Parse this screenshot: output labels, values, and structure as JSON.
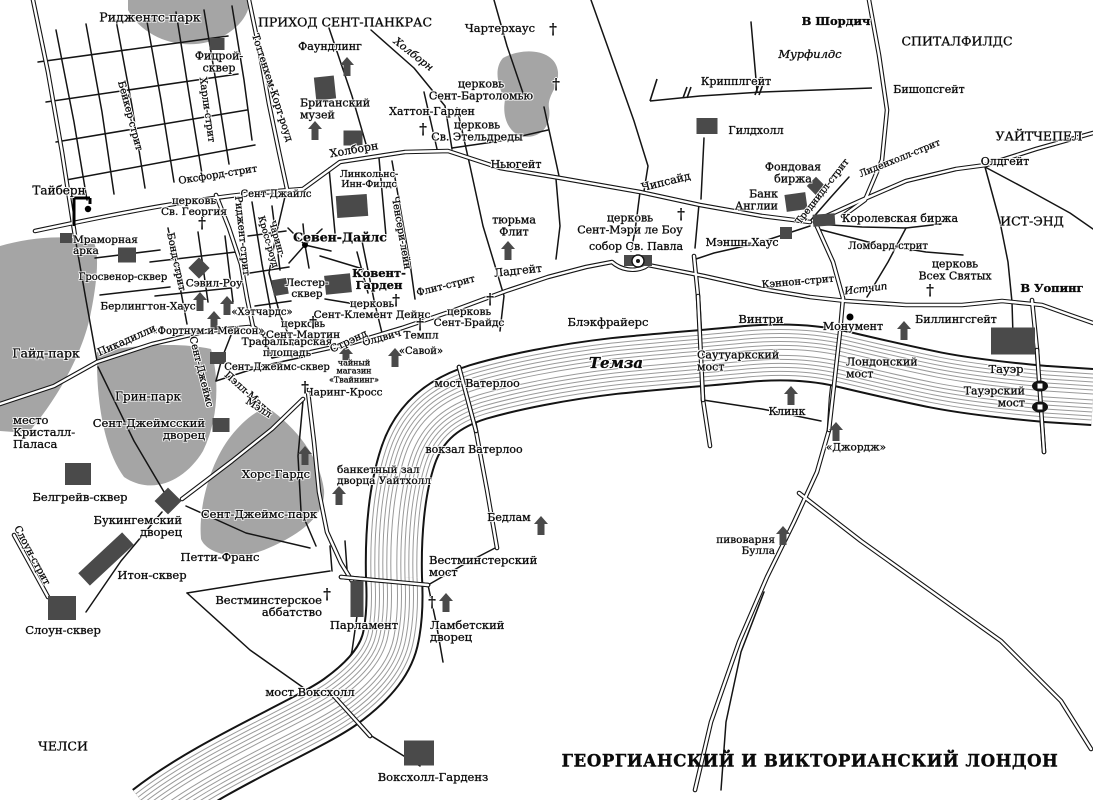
{
  "title": "ГЕОРГИАНСКИЙ И ВИКТОРИАНСКИЙ ЛОНДОН",
  "map": {
    "river_name": "Темза",
    "cross_glyph": "†",
    "labels": [
      {
        "t": "Риджентс-парк",
        "x": 150,
        "y": 17,
        "s": 12.5
      },
      {
        "t": "ПРИХОД СЕНТ-ПАНКРАС",
        "x": 345,
        "y": 22,
        "s": 12.5
      },
      {
        "t": "Чартерхаус",
        "x": 500,
        "y": 28,
        "s": 11.5
      },
      {
        "t": "В Шордич",
        "x": 836,
        "y": 21,
        "s": 11.5,
        "b": 1
      },
      {
        "t": "СПИТАЛФИЛДС",
        "x": 957,
        "y": 41,
        "s": 12.5
      },
      {
        "t": "Мурфилдс",
        "x": 810,
        "y": 54,
        "s": 11.5,
        "i": 1
      },
      {
        "t": "Фицрой-|сквер",
        "x": 219,
        "y": 62,
        "s": 11
      },
      {
        "t": "Фаундлинг",
        "x": 330,
        "y": 47,
        "s": 11
      },
      {
        "t": "Холборн",
        "x": 413,
        "y": 55,
        "s": 10.5,
        "i": 1,
        "r": 38
      },
      {
        "t": "церковь|Сент-Бартоломью",
        "x": 481,
        "y": 90,
        "s": 11
      },
      {
        "t": "Крипплгейт",
        "x": 736,
        "y": 82,
        "s": 11
      },
      {
        "t": "Бишопсгейт",
        "x": 929,
        "y": 90,
        "s": 11
      },
      {
        "t": "Британский|музей",
        "x": 300,
        "y": 109,
        "s": 11,
        "a": "l"
      },
      {
        "t": "Хаттон-Гарден",
        "x": 432,
        "y": 112,
        "s": 11
      },
      {
        "t": "церковь|Св. Этельдреды",
        "x": 477,
        "y": 131,
        "s": 11
      },
      {
        "t": "УАЙТЧЕПЕЛ",
        "x": 1039,
        "y": 136,
        "s": 12.5
      },
      {
        "t": "Гилдхолл",
        "x": 756,
        "y": 131,
        "s": 11
      },
      {
        "t": "Холборн",
        "x": 354,
        "y": 150,
        "s": 11,
        "r": -10
      },
      {
        "t": "Ньюгейт",
        "x": 516,
        "y": 165,
        "s": 11
      },
      {
        "t": "Олдгейт",
        "x": 1005,
        "y": 162,
        "s": 11
      },
      {
        "t": "Оксфорд-стрит",
        "x": 218,
        "y": 176,
        "s": 10,
        "r": -9
      },
      {
        "t": "Линкольнс-|Инн-Филдс",
        "x": 369,
        "y": 180,
        "s": 9.5
      },
      {
        "t": "Фондовая|биржа",
        "x": 793,
        "y": 173,
        "s": 11
      },
      {
        "t": "Тайберн",
        "x": 59,
        "y": 191,
        "s": 12
      },
      {
        "t": "Сент-Джайлс",
        "x": 276,
        "y": 195,
        "s": 10
      },
      {
        "t": "церковь|Св. Георгия",
        "x": 194,
        "y": 207,
        "s": 10.5
      },
      {
        "t": "Банк|Англии",
        "x": 778,
        "y": 200,
        "s": 11,
        "a": "r"
      },
      {
        "t": "Королевская биржа",
        "x": 900,
        "y": 219,
        "s": 11
      },
      {
        "t": "Лиденхолл-стрит",
        "x": 900,
        "y": 159,
        "s": 9.5,
        "r": -22
      },
      {
        "t": "Треднидл-стрит",
        "x": 823,
        "y": 192,
        "s": 9.5,
        "r": -52
      },
      {
        "t": "тюрьма|Флит",
        "x": 514,
        "y": 226,
        "s": 11
      },
      {
        "t": "ИСТ-ЭНД",
        "x": 1032,
        "y": 221,
        "s": 12.5
      },
      {
        "t": "Севен-Дайлс",
        "x": 340,
        "y": 237,
        "s": 12.5,
        "b": 1
      },
      {
        "t": "церковь|Сент-Мэри ле Боу",
        "x": 630,
        "y": 224,
        "s": 11
      },
      {
        "t": "собор Св. Павла",
        "x": 636,
        "y": 247,
        "s": 11
      },
      {
        "t": "Мэншн-Хаус",
        "x": 742,
        "y": 243,
        "s": 11
      },
      {
        "t": "Ломбард-стрит",
        "x": 888,
        "y": 247,
        "s": 10
      },
      {
        "t": "церковь|Всех Святых",
        "x": 955,
        "y": 270,
        "s": 11
      },
      {
        "t": "В Уопинг",
        "x": 1052,
        "y": 288,
        "s": 11.5,
        "b": 1
      },
      {
        "t": "Мраморная|арка",
        "x": 73,
        "y": 246,
        "s": 10.5,
        "a": "l"
      },
      {
        "t": "Чипсайд",
        "x": 666,
        "y": 182,
        "s": 11,
        "r": -14
      },
      {
        "t": "Гайд-парк",
        "x": 46,
        "y": 353,
        "s": 12.5
      },
      {
        "t": "Гросвенор-сквер",
        "x": 123,
        "y": 278,
        "s": 10
      },
      {
        "t": "Сэвил-Роу",
        "x": 214,
        "y": 284,
        "s": 10.5
      },
      {
        "t": "Лестер-|сквер",
        "x": 307,
        "y": 289,
        "s": 10.5
      },
      {
        "t": "Ковент-|Гарден",
        "x": 379,
        "y": 279,
        "s": 11.5,
        "b": 1
      },
      {
        "t": "Берлингтон-Хаус",
        "x": 148,
        "y": 307,
        "s": 10.5
      },
      {
        "t": "«Хэтчардс»",
        "x": 262,
        "y": 313,
        "s": 10
      },
      {
        "t": "церковь|Сент-Мартин",
        "x": 303,
        "y": 330,
        "s": 10.5
      },
      {
        "t": "«Фортнум и Мейсон»",
        "x": 208,
        "y": 332,
        "s": 10
      },
      {
        "t": "Пикадилли",
        "x": 127,
        "y": 341,
        "s": 10.5,
        "r": -24
      },
      {
        "t": "Трафальгарская|площадь",
        "x": 287,
        "y": 348,
        "s": 10.5
      },
      {
        "t": "Сент-Джеймс-сквер",
        "x": 277,
        "y": 368,
        "s": 10
      },
      {
        "t": "чайный|магазин|«Твайнинг»",
        "x": 354,
        "y": 372,
        "s": 8
      },
      {
        "t": "Чаринг-Кросс",
        "x": 344,
        "y": 393,
        "s": 10.5
      },
      {
        "t": "церковь|Сент-Клемент Дейнс",
        "x": 372,
        "y": 310,
        "s": 10.5
      },
      {
        "t": "Темпл",
        "x": 421,
        "y": 336,
        "s": 10.5
      },
      {
        "t": "«Савой»",
        "x": 421,
        "y": 352,
        "s": 10
      },
      {
        "t": "Олдвич",
        "x": 382,
        "y": 339,
        "s": 10,
        "r": -15
      },
      {
        "t": "Стрэнд",
        "x": 349,
        "y": 342,
        "s": 10.5,
        "r": -25
      },
      {
        "t": "Флит-стрит",
        "x": 446,
        "y": 287,
        "s": 10,
        "r": -14
      },
      {
        "t": "Ладгейт",
        "x": 518,
        "y": 271,
        "s": 11,
        "r": -6
      },
      {
        "t": "церковь|Сент-Брайдс",
        "x": 469,
        "y": 318,
        "s": 10.5
      },
      {
        "t": "Блэкфрайерс",
        "x": 608,
        "y": 322,
        "s": 11.5
      },
      {
        "t": "Темза",
        "x": 616,
        "y": 364,
        "s": 15,
        "b": 1,
        "i": 1
      },
      {
        "t": "мост Ватерлоо",
        "x": 477,
        "y": 384,
        "s": 11
      },
      {
        "t": "вокзал Ватерлоо",
        "x": 474,
        "y": 450,
        "s": 11
      },
      {
        "t": "банкетный зал|дворца Уайтхолл",
        "x": 337,
        "y": 476,
        "s": 10.5,
        "a": "l"
      },
      {
        "t": "Бедлам",
        "x": 509,
        "y": 518,
        "s": 11
      },
      {
        "t": "Саутуаркский|мост",
        "x": 697,
        "y": 361,
        "s": 11,
        "a": "l"
      },
      {
        "t": "Винтри",
        "x": 761,
        "y": 319,
        "s": 11.5
      },
      {
        "t": "Монумент",
        "x": 853,
        "y": 327,
        "s": 11
      },
      {
        "t": "Биллингсгейт",
        "x": 956,
        "y": 320,
        "s": 11
      },
      {
        "t": "Лондонский|мост",
        "x": 846,
        "y": 368,
        "s": 11,
        "a": "l"
      },
      {
        "t": "Тауэр",
        "x": 1006,
        "y": 369,
        "s": 11.5
      },
      {
        "t": "Тауэрский|мост",
        "x": 1025,
        "y": 397,
        "s": 11,
        "a": "r"
      },
      {
        "t": "Клинк",
        "x": 787,
        "y": 412,
        "s": 11
      },
      {
        "t": "«Джордж»",
        "x": 856,
        "y": 448,
        "s": 10.5
      },
      {
        "t": "Кэннон-стрит",
        "x": 798,
        "y": 283,
        "s": 10,
        "r": -5
      },
      {
        "t": "Истчип",
        "x": 866,
        "y": 290,
        "s": 10,
        "i": 1,
        "r": -7
      },
      {
        "t": "место|Кристалл-|Паласа",
        "x": 13,
        "y": 432,
        "s": 11.5,
        "a": "l"
      },
      {
        "t": "Грин-парк",
        "x": 148,
        "y": 397,
        "s": 12
      },
      {
        "t": "Сент-Джеймсский|дворец",
        "x": 205,
        "y": 429,
        "s": 11.5,
        "a": "r"
      },
      {
        "t": "Белгрейв-сквер",
        "x": 80,
        "y": 497,
        "s": 11.5
      },
      {
        "t": "Букингемский|дворец",
        "x": 182,
        "y": 526,
        "s": 11.5,
        "a": "r"
      },
      {
        "t": "Хорс-Гардс",
        "x": 276,
        "y": 474,
        "s": 11.5
      },
      {
        "t": "Сент-Джеймс-парк",
        "x": 259,
        "y": 514,
        "s": 11.5
      },
      {
        "t": "Петти-Франс",
        "x": 220,
        "y": 557,
        "s": 11.5
      },
      {
        "t": "Итон-сквер",
        "x": 152,
        "y": 575,
        "s": 11.5
      },
      {
        "t": "Слоун-сквер",
        "x": 63,
        "y": 630,
        "s": 11.5
      },
      {
        "t": "Вестминстерское|аббатство",
        "x": 322,
        "y": 606,
        "s": 11.5,
        "a": "r"
      },
      {
        "t": "Парламент",
        "x": 364,
        "y": 625,
        "s": 11.5
      },
      {
        "t": "Вестминстерский|мост",
        "x": 429,
        "y": 566,
        "s": 11.5,
        "a": "l"
      },
      {
        "t": "Ламбетский|дворец",
        "x": 430,
        "y": 631,
        "s": 11.5,
        "a": "l"
      },
      {
        "t": "мост Воксхолл",
        "x": 310,
        "y": 692,
        "s": 11.5
      },
      {
        "t": "Воксхолл-Гарденз",
        "x": 433,
        "y": 777,
        "s": 11.5
      },
      {
        "t": "пивоварня|Булла",
        "x": 775,
        "y": 546,
        "s": 10.5,
        "a": "r"
      },
      {
        "t": "ЧЕЛСИ",
        "x": 63,
        "y": 746,
        "s": 12.5
      },
      {
        "t": "Бейкер-стрит",
        "x": 129,
        "y": 116,
        "s": 10,
        "r": 75
      },
      {
        "t": "Харли-стрит",
        "x": 206,
        "y": 110,
        "s": 10,
        "r": 82
      },
      {
        "t": "Тоттенхем-Корт-роуд",
        "x": 271,
        "y": 88,
        "s": 10,
        "r": 72
      },
      {
        "t": "Бонд-стрит",
        "x": 175,
        "y": 262,
        "s": 10,
        "r": 78
      },
      {
        "t": "Риджент-стрит",
        "x": 241,
        "y": 236,
        "s": 10,
        "r": 84
      },
      {
        "t": "Чаринг-|Кросс-роуд",
        "x": 271,
        "y": 241,
        "s": 9,
        "r": 74
      },
      {
        "t": "Ченсери-лейн",
        "x": 400,
        "y": 233,
        "s": 10,
        "r": 80
      },
      {
        "t": "Сент-Джеймс",
        "x": 200,
        "y": 372,
        "s": 10,
        "r": 76
      },
      {
        "t": "Пэлл-Мэлл",
        "x": 247,
        "y": 394,
        "s": 10,
        "r": 42
      },
      {
        "t": "Мэлл",
        "x": 258,
        "y": 409,
        "s": 10,
        "r": 32
      },
      {
        "t": "Слоун-стрит",
        "x": 31,
        "y": 556,
        "s": 10,
        "r": 62
      }
    ],
    "crosses": [
      [
        553,
        30
      ],
      [
        556,
        85
      ],
      [
        423,
        130
      ],
      [
        202,
        224
      ],
      [
        681,
        215
      ],
      [
        930,
        291
      ],
      [
        396,
        301
      ],
      [
        490,
        300
      ],
      [
        420,
        325
      ],
      [
        313,
        323
      ],
      [
        305,
        388
      ],
      [
        327,
        595
      ],
      [
        432,
        603
      ]
    ],
    "houses": [
      [
        347,
        67
      ],
      [
        315,
        131
      ],
      [
        508,
        251
      ],
      [
        200,
        302
      ],
      [
        227,
        306
      ],
      [
        214,
        321
      ],
      [
        346,
        356
      ],
      [
        395,
        358
      ],
      [
        305,
        456
      ],
      [
        339,
        496
      ],
      [
        541,
        526
      ],
      [
        446,
        603
      ],
      [
        783,
        536
      ],
      [
        836,
        432
      ],
      [
        791,
        396
      ],
      [
        904,
        331
      ]
    ],
    "buildings": [
      [
        217,
        44,
        15,
        12,
        0
      ],
      [
        325,
        88,
        20,
        23,
        -6
      ],
      [
        353,
        138,
        19,
        15,
        0
      ],
      [
        352,
        206,
        31,
        22,
        -4
      ],
      [
        338,
        284,
        26,
        19,
        -6
      ],
      [
        280,
        287,
        15,
        16,
        -10
      ],
      [
        127,
        255,
        18,
        15,
        0
      ],
      [
        199,
        268,
        15,
        15,
        45
      ],
      [
        218,
        358,
        16,
        12,
        0
      ],
      [
        221,
        425,
        17,
        14,
        0
      ],
      [
        168,
        501,
        19,
        19,
        45
      ],
      [
        106,
        559,
        60,
        17,
        -43
      ],
      [
        62,
        608,
        28,
        24,
        0
      ],
      [
        78,
        474,
        26,
        22,
        0
      ],
      [
        357,
        599,
        13,
        36,
        0
      ],
      [
        419,
        753,
        30,
        25,
        0
      ],
      [
        707,
        126,
        21,
        16,
        0
      ],
      [
        796,
        202,
        21,
        17,
        -8
      ],
      [
        816,
        186,
        13,
        13,
        45
      ],
      [
        824,
        220,
        22,
        12,
        -4
      ],
      [
        786,
        233,
        12,
        12,
        0
      ],
      [
        1013,
        341,
        44,
        27,
        0
      ],
      [
        66,
        238,
        12,
        10,
        0
      ]
    ],
    "dots": [
      [
        850,
        317,
        3.5
      ],
      [
        305,
        245,
        3
      ]
    ],
    "gates": [
      [
        690,
        93
      ],
      [
        762,
        90
      ]
    ],
    "bridge_towers": [
      [
        1040,
        386
      ],
      [
        1040,
        407
      ]
    ],
    "gallows": [
      74,
      198
    ],
    "cathedral": [
      638,
      261
    ]
  }
}
